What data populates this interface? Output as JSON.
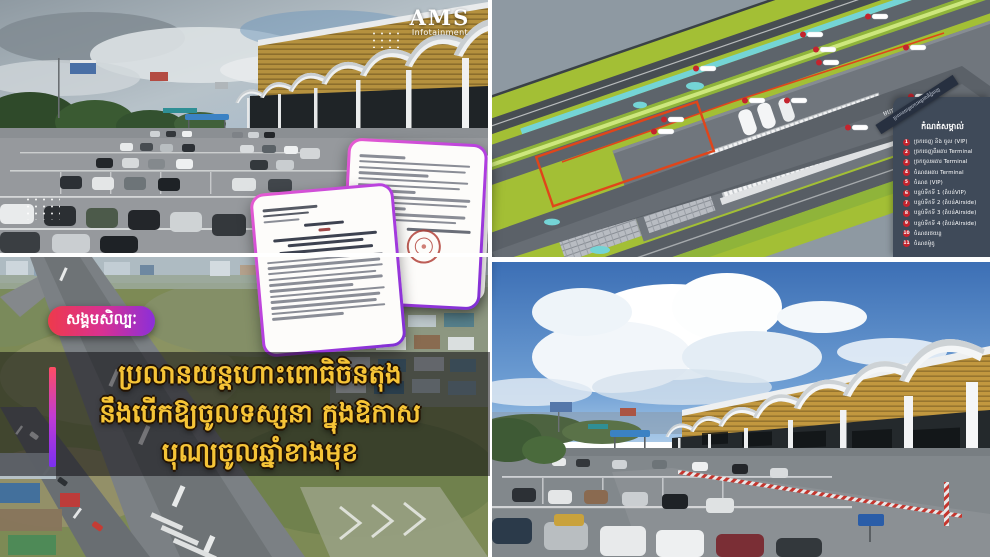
{
  "brand": {
    "name": "AMS",
    "tagline": "Infotainment"
  },
  "overlay": {
    "category_badge": "សង្គមសិល្បៈ",
    "headline": {
      "line1": "ប្រលានយន្តហោះពោធិចិនតុង",
      "line2": "នឹងបើកឱ្យចូលទស្សនា ក្នុងឱកាស",
      "line3": "បុណ្យចូលឆ្នាំខាងមុខ"
    },
    "colors": {
      "badge_gradient_start": "#ee3a4c",
      "badge_gradient_end": "#8b2fd9",
      "headline_yellow": "#f6c437",
      "document_border": "#b13ee0"
    }
  },
  "diagram": {
    "ribbon": "ប្រលានយន្តហោះអន្តរជាតិភ្នំពេញ",
    "road_label": "មហាវិថីសហព័ន្ធរុស្ស៊ី",
    "legend": {
      "title": "កំណត់សម្គាល់",
      "items": [
        {
          "num": "1",
          "label": "ច្រកចេញ និង ចូល (VIP)"
        },
        {
          "num": "2",
          "label": "ច្រកចេញពីអគារ Terminal"
        },
        {
          "num": "3",
          "label": "ច្រកចូលអគារ Terminal"
        },
        {
          "num": "4",
          "label": "ចំណតអគារ Terminal"
        },
        {
          "num": "5",
          "label": "ចំណត (VIP)"
        },
        {
          "num": "6",
          "label": "បន្ទប់ទឹកទី 1 (តំបន់VIP)"
        },
        {
          "num": "7",
          "label": "បន្ទប់ទឹកទី 2 (តំបន់Airside)"
        },
        {
          "num": "8",
          "label": "បន្ទប់ទឹកទី 3 (តំបន់Airside)"
        },
        {
          "num": "9",
          "label": "បន្ទប់ទឹកទី 4 (តំបន់Airside)"
        },
        {
          "num": "10",
          "label": "ចំណតរថយន្ត"
        },
        {
          "num": "11",
          "label": "ចំណតម៉ូតូ"
        }
      ],
      "marker_color": "#c4242e"
    }
  }
}
